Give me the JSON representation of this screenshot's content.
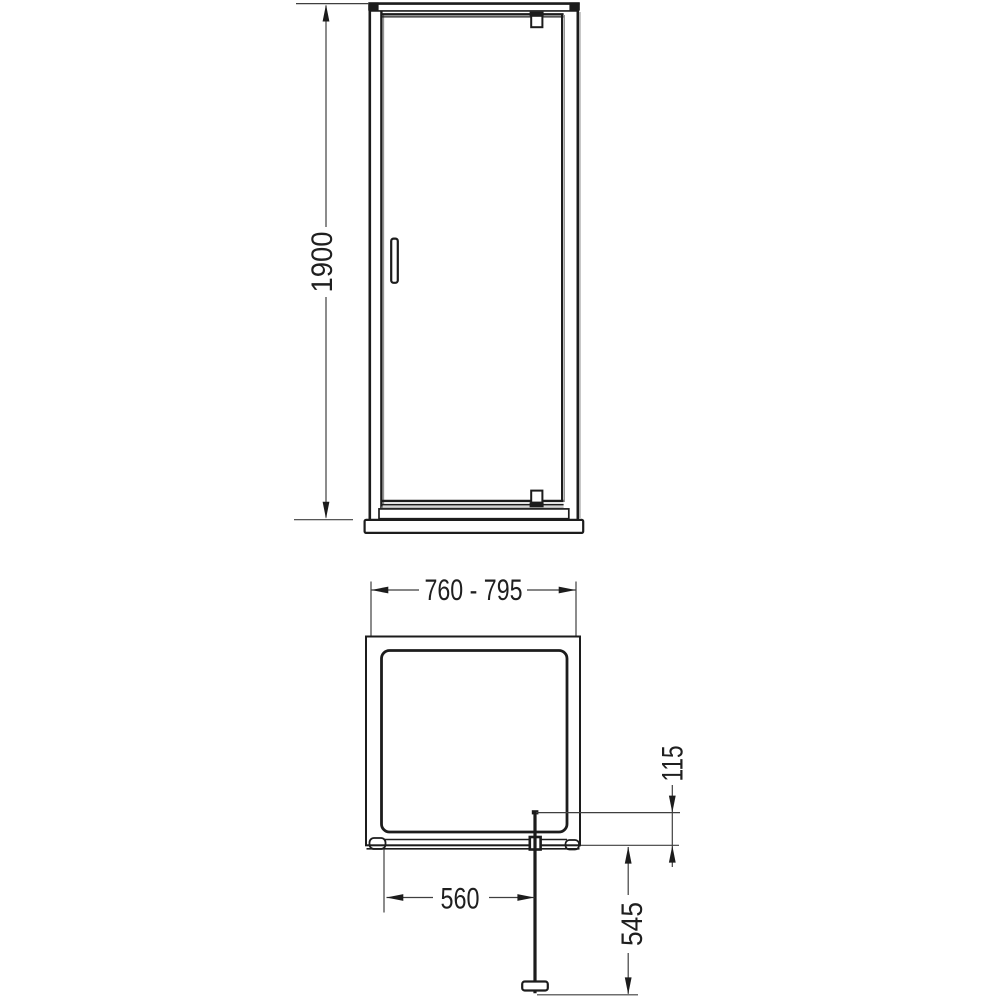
{
  "colors": {
    "background": "#ffffff",
    "line": "#1c1c1c",
    "dimension_line": "#3f3f3f",
    "shade_line": "#8f8f8f",
    "text": "#1f1f1f"
  },
  "drawing": {
    "kind": "technical dimension drawing",
    "subject": "pivot-door shower enclosure",
    "views": [
      {
        "id": "front-elevation",
        "name": "front elevation",
        "parts": [
          "outer frame",
          "pivot door panel",
          "door handle",
          "top pivot hinge",
          "bottom pivot hinge",
          "bottom frame bar",
          "shower tray"
        ]
      },
      {
        "id": "plan",
        "name": "plan view",
        "parts": [
          "enclosure outline",
          "tray inner outline",
          "open pivot door leaf",
          "door handle",
          "pivot block"
        ]
      }
    ],
    "dimensions": {
      "overall_height": {
        "label": "1900",
        "view": "front-elevation",
        "orientation": "vertical"
      },
      "width_range": {
        "label": "760 - 795",
        "view": "plan",
        "orientation": "horizontal"
      },
      "door_glass_width": {
        "label": "560",
        "view": "plan",
        "orientation": "horizontal"
      },
      "pivot_inset": {
        "label": "115",
        "view": "plan",
        "orientation": "vertical"
      },
      "door_projection": {
        "label": "545",
        "view": "plan",
        "orientation": "vertical"
      }
    }
  }
}
